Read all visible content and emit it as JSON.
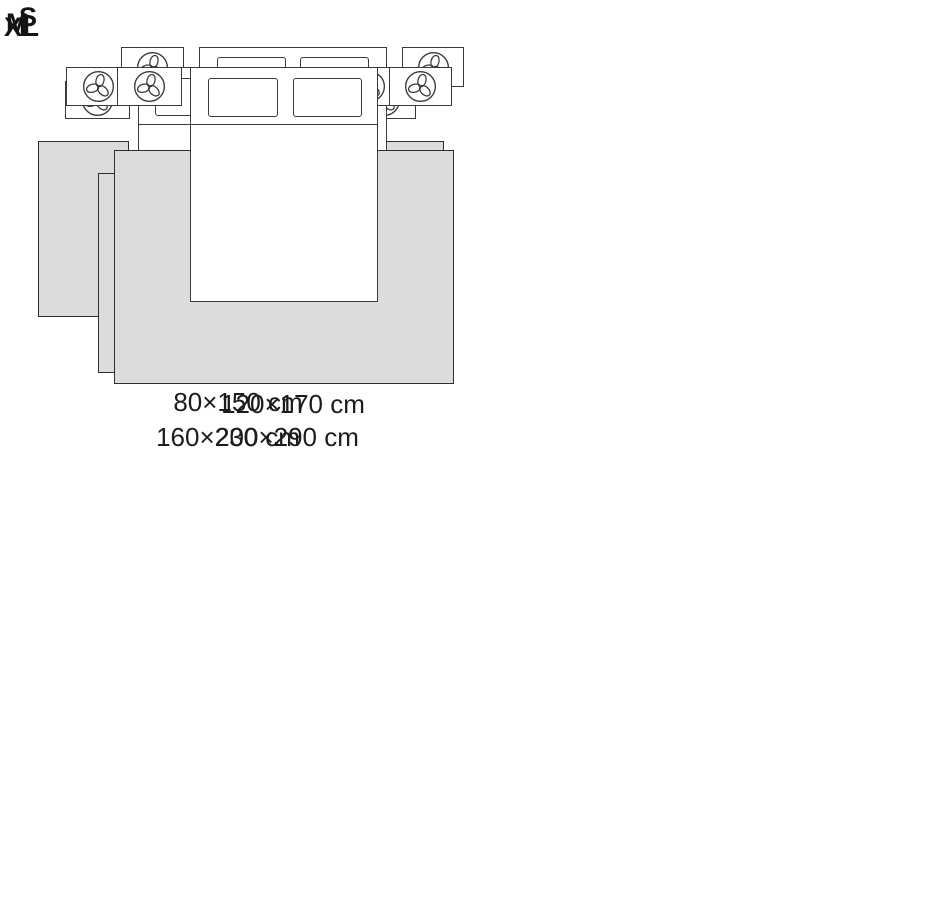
{
  "diagram": {
    "type": "rug-size-guide",
    "unit": "cm",
    "colors": {
      "rug_fill": "#dcdcdc",
      "outline": "#3a3a3a",
      "text": "#1c1c1c",
      "background": "#ffffff"
    },
    "icons": {
      "nightstand_decor": "plant-icon"
    }
  },
  "panels": [
    {
      "label": "S",
      "size": "80×150 cm",
      "rug_placement": "two bedside runner rugs, one on each side of the bed"
    },
    {
      "label": "M",
      "size": "120×170 cm",
      "rug_placement": "rug under the foot of the bed, slightly wider than the bed"
    },
    {
      "label": "L",
      "size": "160×230 cm",
      "rug_placement": "rug under lower two-thirds of the bed, extending past both sides and the foot"
    },
    {
      "label": "XL",
      "size": "200×290 cm",
      "rug_placement": "large rug under most of the bed, extending widely past both sides and the foot"
    }
  ]
}
